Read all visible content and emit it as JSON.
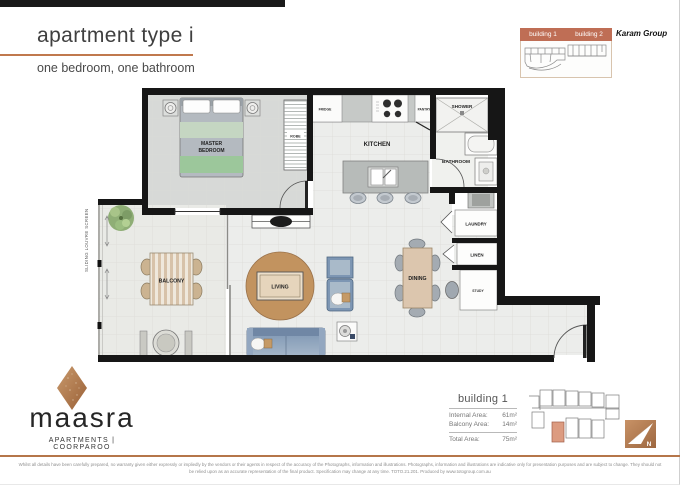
{
  "header": {
    "title": "apartment type i",
    "subtitle": "one bedroom, one bathroom"
  },
  "site_selector": {
    "building1_label": "building 1",
    "building2_label": "building 2"
  },
  "developer_logo": "Karam Group",
  "floorplan": {
    "labels": {
      "master_bedroom_line1": "MASTER",
      "master_bedroom_line2": "BEDROOM",
      "robe": "ROBE",
      "fridge": "FRIDGE",
      "kitchen": "KITCHEN",
      "pantry": "PANTRY",
      "shower": "SHOWER",
      "bathroom": "BATHROOM",
      "laundry": "LAUNDRY",
      "linen": "LINEN",
      "study": "STUDY",
      "dining": "DINING",
      "living": "LIVING",
      "balcony": "BALCONY",
      "sliding_screen": "SLIDING LOUVRE SCREEN"
    }
  },
  "area_info": {
    "building": "building 1",
    "rows": [
      {
        "label": "Internal Area:",
        "value": "61m²"
      },
      {
        "label": "Balcony Area:",
        "value": "14m²"
      },
      {
        "label": "Total Area:",
        "value": "75m²"
      }
    ]
  },
  "north_indicator": "N",
  "brand": {
    "name": "maasra",
    "tagline": "APARTMENTS | COORPAROO"
  },
  "disclaimer": {
    "line1": "Whilst all details have been carefully prepared, no warranty given either expressly or impliedly by the vendors or their agents in respect of the accuracy of the Photographs, information and illustrations. Photographs, information and illustrations are indicative only for presentation purposes and are subject to change. They should not",
    "line2": "be relied upon as an accurate representation of the final product. Specification may change at any time. TOTO.21.201. Produced by www.totogroup.com.au"
  },
  "colors": {
    "accent_copper": "#b5764a",
    "selector_bar": "#bf6e55",
    "wall_black": "#161616",
    "rug_tan": "#c2935f",
    "sofa_blue": "#7a93b1",
    "bed_green": "#9cc79b",
    "highlight_unit": "#dc9b80"
  }
}
